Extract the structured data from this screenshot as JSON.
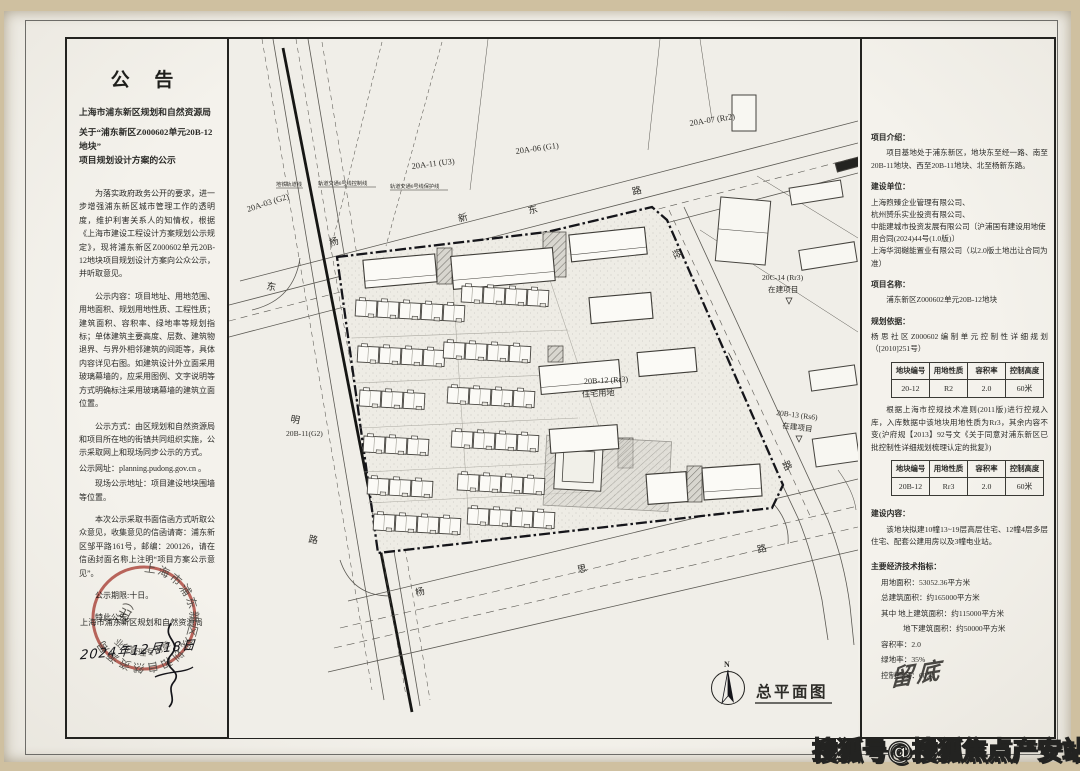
{
  "notice": {
    "title": "公 告",
    "org": "上海市浦东新区规划和自然资源局",
    "subject_line1": "关于“浦东新区Z000602单元20B-12地块”",
    "subject_line2": "项目规划设计方案的公示",
    "paragraphs": {
      "p1": "为落实政府政务公开的要求，进一步增强浦东新区城市管理工作的透明度，维护利害关系人的知情权，根据《上海市建设工程设计方案规划公示规定》，现将浦东新区Z000602单元20B-12地块项目规划设计方案向公众公示，并听取意见。",
      "p2": "公示内容：项目地址、用地范围、用地面积、规划用地性质、工程性质；建筑面积、容积率、绿地率等规划指标；单体建筑主要高度、层数、建筑物退界、与界外相邻建筑的间距等，具体内容详见右图。如建筑设计外立面采用玻璃幕墙的，应采用图例、文字说明等方式明确标注采用玻璃幕墙的建筑立面位置。",
      "p3": "公示方式：由区规划和自然资源局和项目所在地的街镇共同组织实施，公示采取网上和现场同步公示的方式。",
      "web": "公示网址：planning.pudong.gov.cn 。",
      "site": "现场公示地址：项目建设地块围墙等位置。",
      "p4": "本次公示采取书面信函方式听取公众意见，收集意见的信函请寄：浦东新区邹平路161号，邮编：200126，请在信函封面名称上注明“项目方案公示意见”。",
      "period": "公示期限:十日。",
      "final": "特此公告。"
    },
    "sign_org": "上海市浦东新区规划和自然资源局",
    "date_line": "2024年12月18日",
    "stamp": {
      "ring": "上海市浦东新区规划和自然资源局",
      "inner": "业务管理专用章",
      "sub": "（出）"
    }
  },
  "info": {
    "intro_heading": "项目介绍：",
    "intro_text": "项目基地处于浦东新区，地块东至经一路、南至20B-11地块、西至20B-11地块、北至杨新东路。",
    "builder_heading": "建设单位：",
    "builders": [
      "上海煦臻企业管理有限公司、",
      "杭州赟乐实业投资有限公司、",
      "中能建城市投资发展有限公司〔沪浦国有建设用地使用合同(2024)44号(1.0版)〕",
      "上海华润樾能置业有限公司（以2.0版土地出让合同为准）"
    ],
    "name_heading": "项目名称：",
    "name_text": "浦东新区Z000602单元20B-12地块",
    "basis_heading": "规划依据：",
    "basis_text": "杨思社区Z000602编制单元控制性详细规划（[2010]251号）",
    "table1": {
      "headers": [
        "地块编号",
        "用地性质",
        "容积率",
        "控制高度"
      ],
      "rows": [
        [
          "20-12",
          "R2",
          "2.0",
          "60米"
        ]
      ]
    },
    "basis_note": "根据上海市控规技术准则(2011版)进行控规入库，入库数据中该地块用地性质为Rr3，其余内容不变(沪府规【2013】92号文《关于同意对浦东新区已批控制性详细规划梳理认定的批复》)",
    "table2": {
      "headers": [
        "地块编号",
        "用地性质",
        "容积率",
        "控制高度"
      ],
      "rows": [
        [
          "20B-12",
          "Rr3",
          "2.0",
          "60米"
        ]
      ]
    },
    "content_heading": "建设内容：",
    "content_text": "该地块拟建10幢13~19层高层住宅、12幢4层多层住宅、配套公建用房以及3幢电业站。",
    "indicators_heading": "主要经济技术指标：",
    "indicators": [
      "用地面积：53052.36平方米",
      "总建筑面积：约165000平方米",
      "其中 地上建筑面积：约115000平方米",
      "地下建筑面积：约50000平方米",
      "容积率：2.0",
      "绿地率：35%",
      "控制高度：60米"
    ],
    "handwritten_note": "留底"
  },
  "map": {
    "plots": {
      "a07": "20A-07 (Rr2)",
      "a06": "20A-06 (G1)",
      "a11": "20A-11 (U3)",
      "a03": "20A-03 (G2)",
      "b11": "20B-11(G2)",
      "b12_line1": "20B-12 (Rr3)",
      "b12_line2": "住宅用地",
      "c14_line1": "20C-14 (Rr3)",
      "c14_line2": "在建项目",
      "b13_line1": "20B-13 (Rs6)",
      "b13_line2": "在建项目"
    },
    "roads": {
      "north": [
        "杨",
        "新",
        "东",
        "路"
      ],
      "west": [
        "东",
        "明",
        "路"
      ],
      "east": [
        "经",
        "一",
        "路"
      ],
      "south": [
        "杨",
        "思",
        "路"
      ]
    },
    "rail_notes": [
      "地铁轨道线",
      "轨道交通6号线控制线",
      "轨道交通6号线保护线"
    ],
    "plan_title": "总平面图",
    "north_label": "N"
  },
  "watermark": "搜狐号@搜狐焦点产安站",
  "colors": {
    "stamp_red": "#b2423a",
    "paper": "#f2f0ea",
    "line": "#3a3a35"
  }
}
